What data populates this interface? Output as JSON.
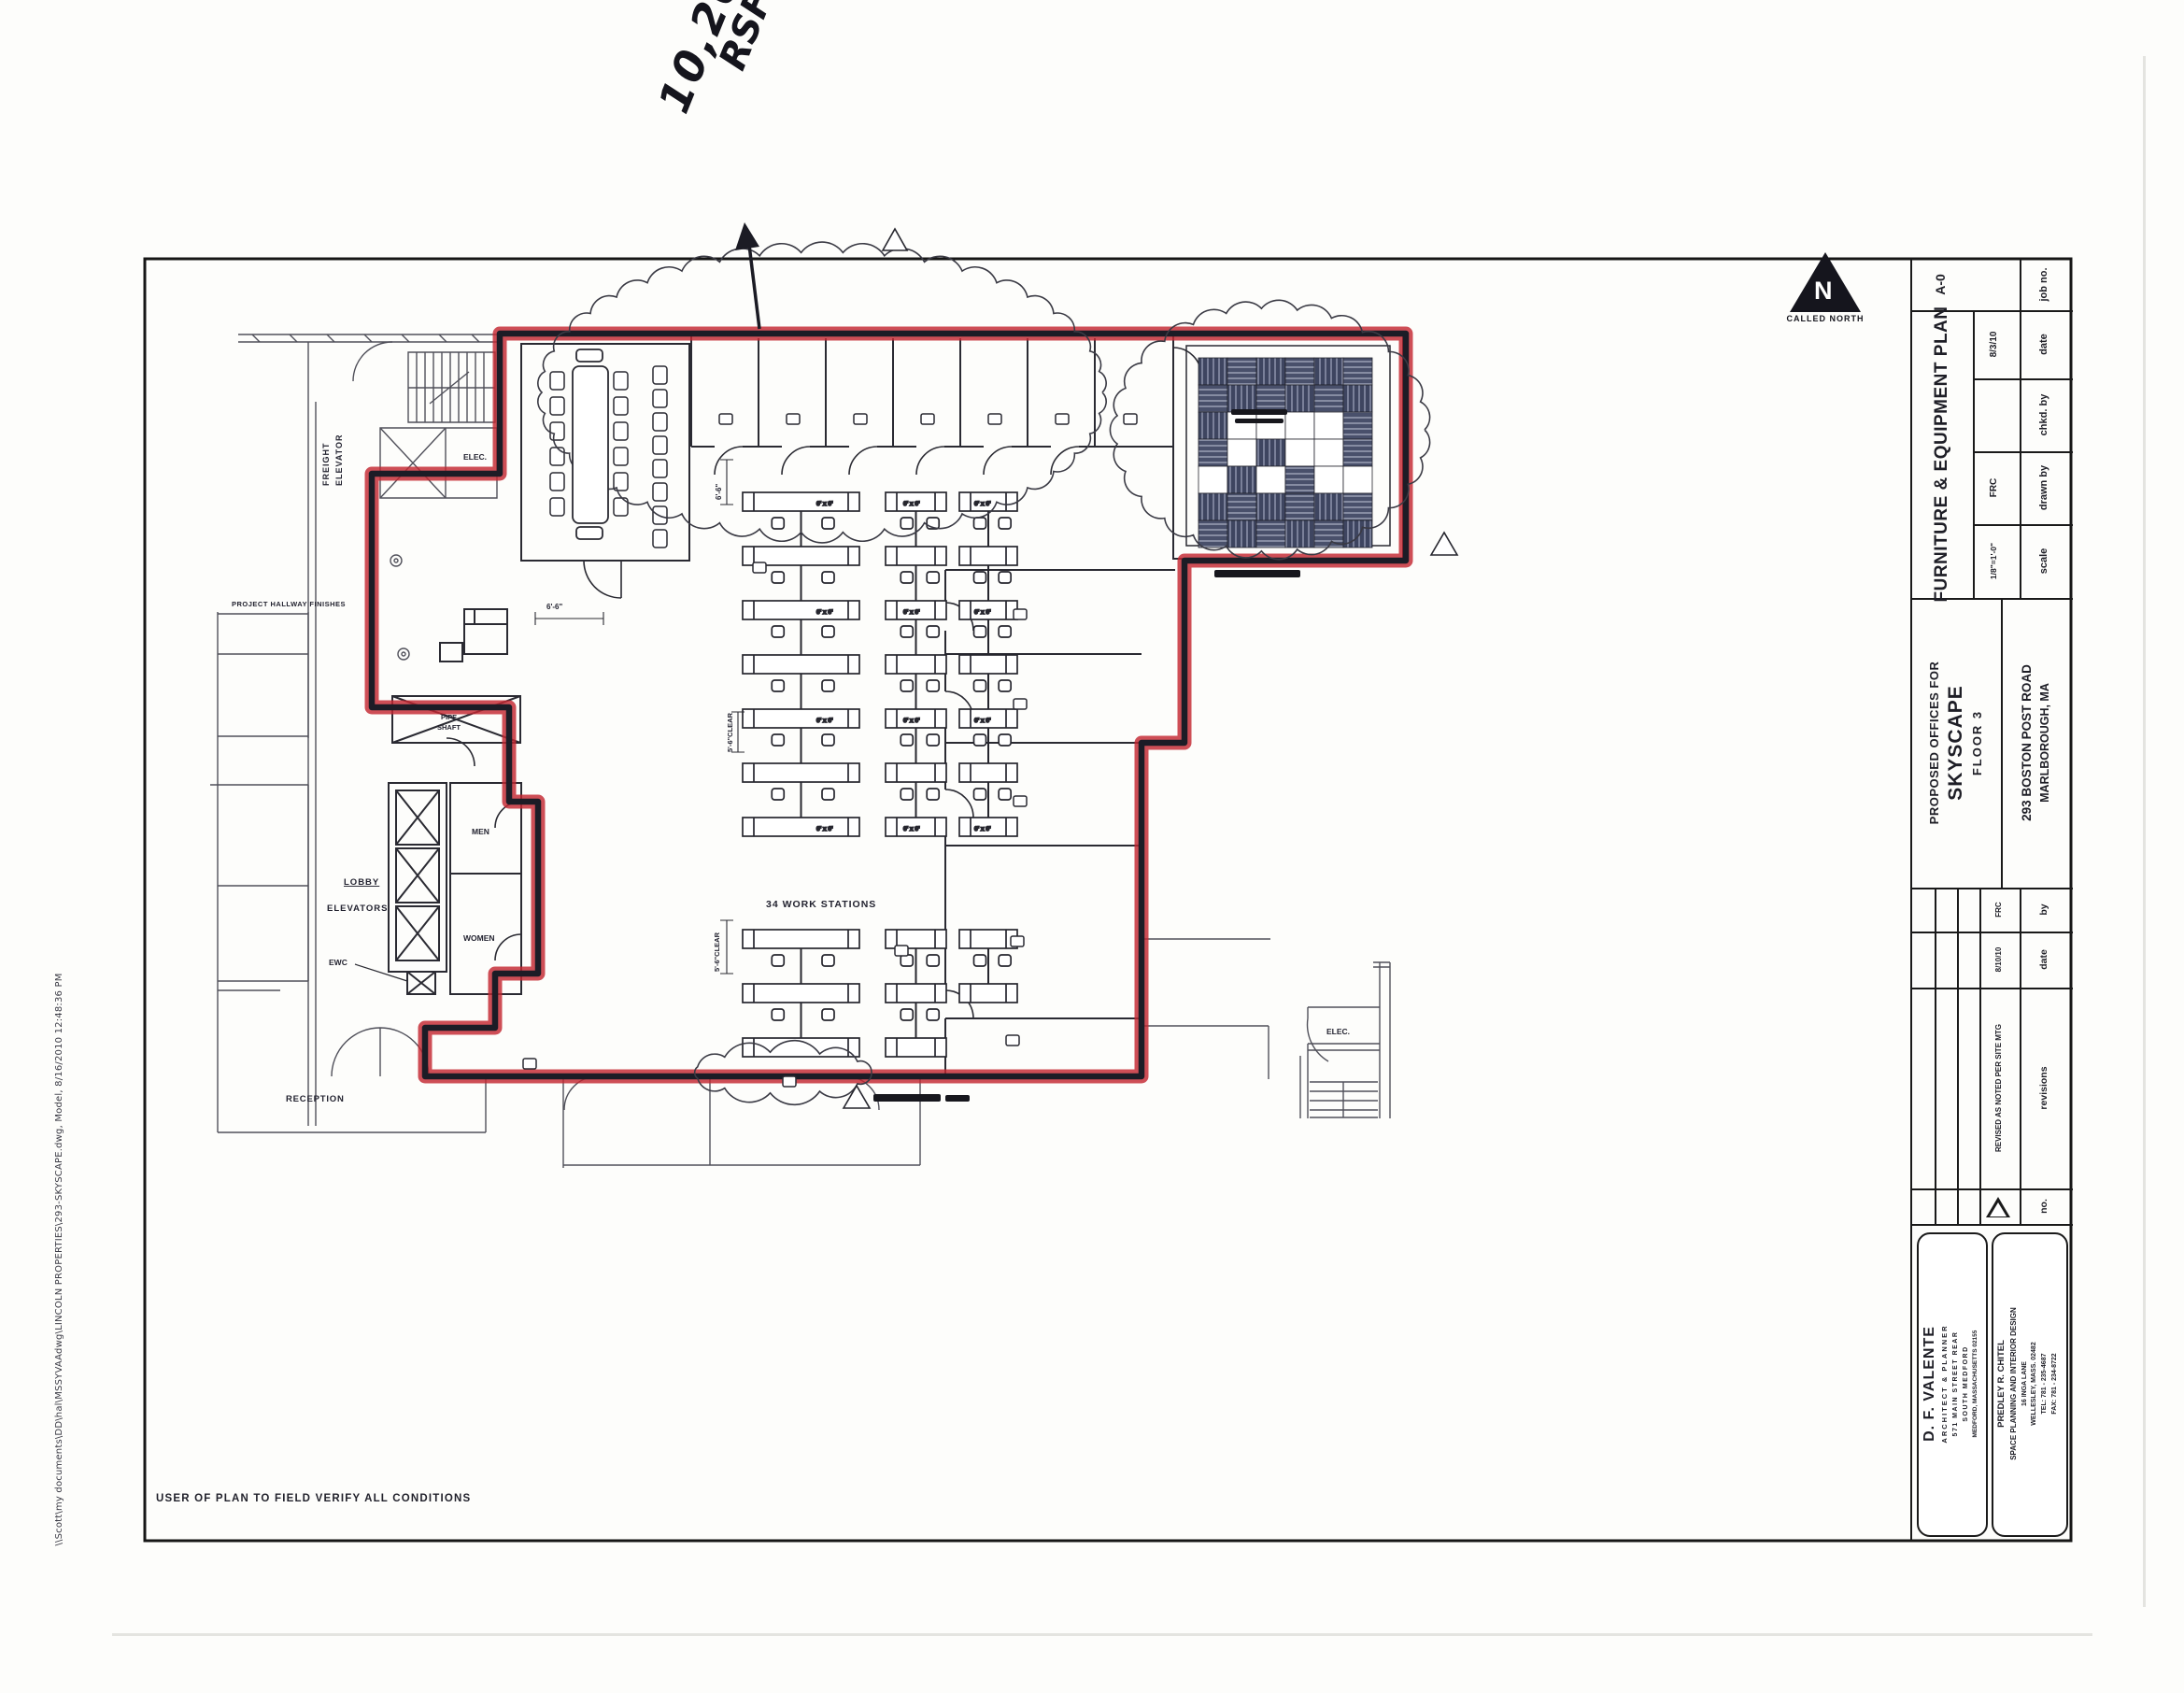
{
  "annotations": {
    "rsf_value": "10,203",
    "rsf_unit": "RSF"
  },
  "north": {
    "letter": "N",
    "caption": "CALLED NORTH"
  },
  "plan": {
    "labels": {
      "freight_line1": "FREIGHT",
      "freight_line2": "ELEVATOR",
      "elec_top": "ELEC.",
      "project_hallway": "PROJECT HALLWAY FINISHES",
      "pipe_line1": "PIPE",
      "pipe_line2": "SHAFT",
      "lobby": "LOBBY",
      "elevators": "ELEVATORS",
      "ewc": "EWC",
      "men": "MEN",
      "women": "WOMEN",
      "reception": "RECEPTION",
      "workstations": "34 WORK STATIONS",
      "elec_bottom": "ELEC.",
      "dim_6_6_a": "6'-6\"",
      "dim_6_6_b": "6'-6\"",
      "dim_5_6_clear_a": "5'-6\"CLEAR",
      "dim_5_6_clear_b": "5'-6\"CLEAR",
      "desk_dim": "6' x 6'"
    },
    "grid_room_tiles": [
      "VHVHVH",
      "HVHVHV",
      "VWWWWH",
      "HWVWWH",
      "WVWHWW",
      "VHVHVH",
      "HVHVHV"
    ]
  },
  "titleblock": {
    "sheet_no": "A-0",
    "sheet_title": "FURNITURE & EQUIPMENT PLAN",
    "fields": {
      "job_no_label": "job no.",
      "date_label": "date",
      "date_value": "8/3/10",
      "chkd_label": "chkd. by",
      "drawn_label": "drawn by",
      "drawn_value": "FRC",
      "scale_label": "scale",
      "scale_value": "1/8\"=1'-0\""
    },
    "project": {
      "line1": "PROPOSED OFFICES FOR",
      "name": "SKYSCAPE",
      "line3": "FLOOR  3",
      "address1": "293 BOSTON POST ROAD",
      "address2": "MARLBOROUGH, MA"
    },
    "revisions": {
      "no_label": "no.",
      "revisions_label": "revisions",
      "date_label": "date",
      "by_label": "by",
      "rev1_text": "REVISED AS NOTED PER SITE MTG",
      "rev1_date": "8/10/10",
      "rev1_by": "FRC"
    },
    "architect": {
      "name": "D. F. VALENTE",
      "title": "ARCHITECT & PLANNER",
      "addr1": "571 MAIN STREET  REAR",
      "addr2": "SOUTH MEDFORD",
      "addr3": "MEDFORD, MASSACHUSETTS 02155"
    },
    "designer": {
      "name": "PREDLEY R. CHITEL",
      "title": "SPACE PLANNING AND INTERIOR DESIGN",
      "addr1": "16 INGA LANE",
      "addr2": "WELLESLEY, MASS. 02482",
      "tel": "TEL: 781 - 235-4687",
      "fax": "FAX: 781 - 234-8722"
    }
  },
  "footer": {
    "note": "USER OF PLAN TO FIELD VERIFY ALL CONDITIONS",
    "filepath": "\\\\Scott\\my documents\\DD\\hal\\MSSYVAAdwg\\LINCOLN PROPERTIES\\293-SKYSCAPE.dwg, Model, 8/16/2010 12:48:36 PM"
  },
  "colors": {
    "marker_red": "#c32731",
    "wall_black": "#1c1c26",
    "line_gray": "#2e2e38",
    "tile_dark": "#3e4560"
  }
}
